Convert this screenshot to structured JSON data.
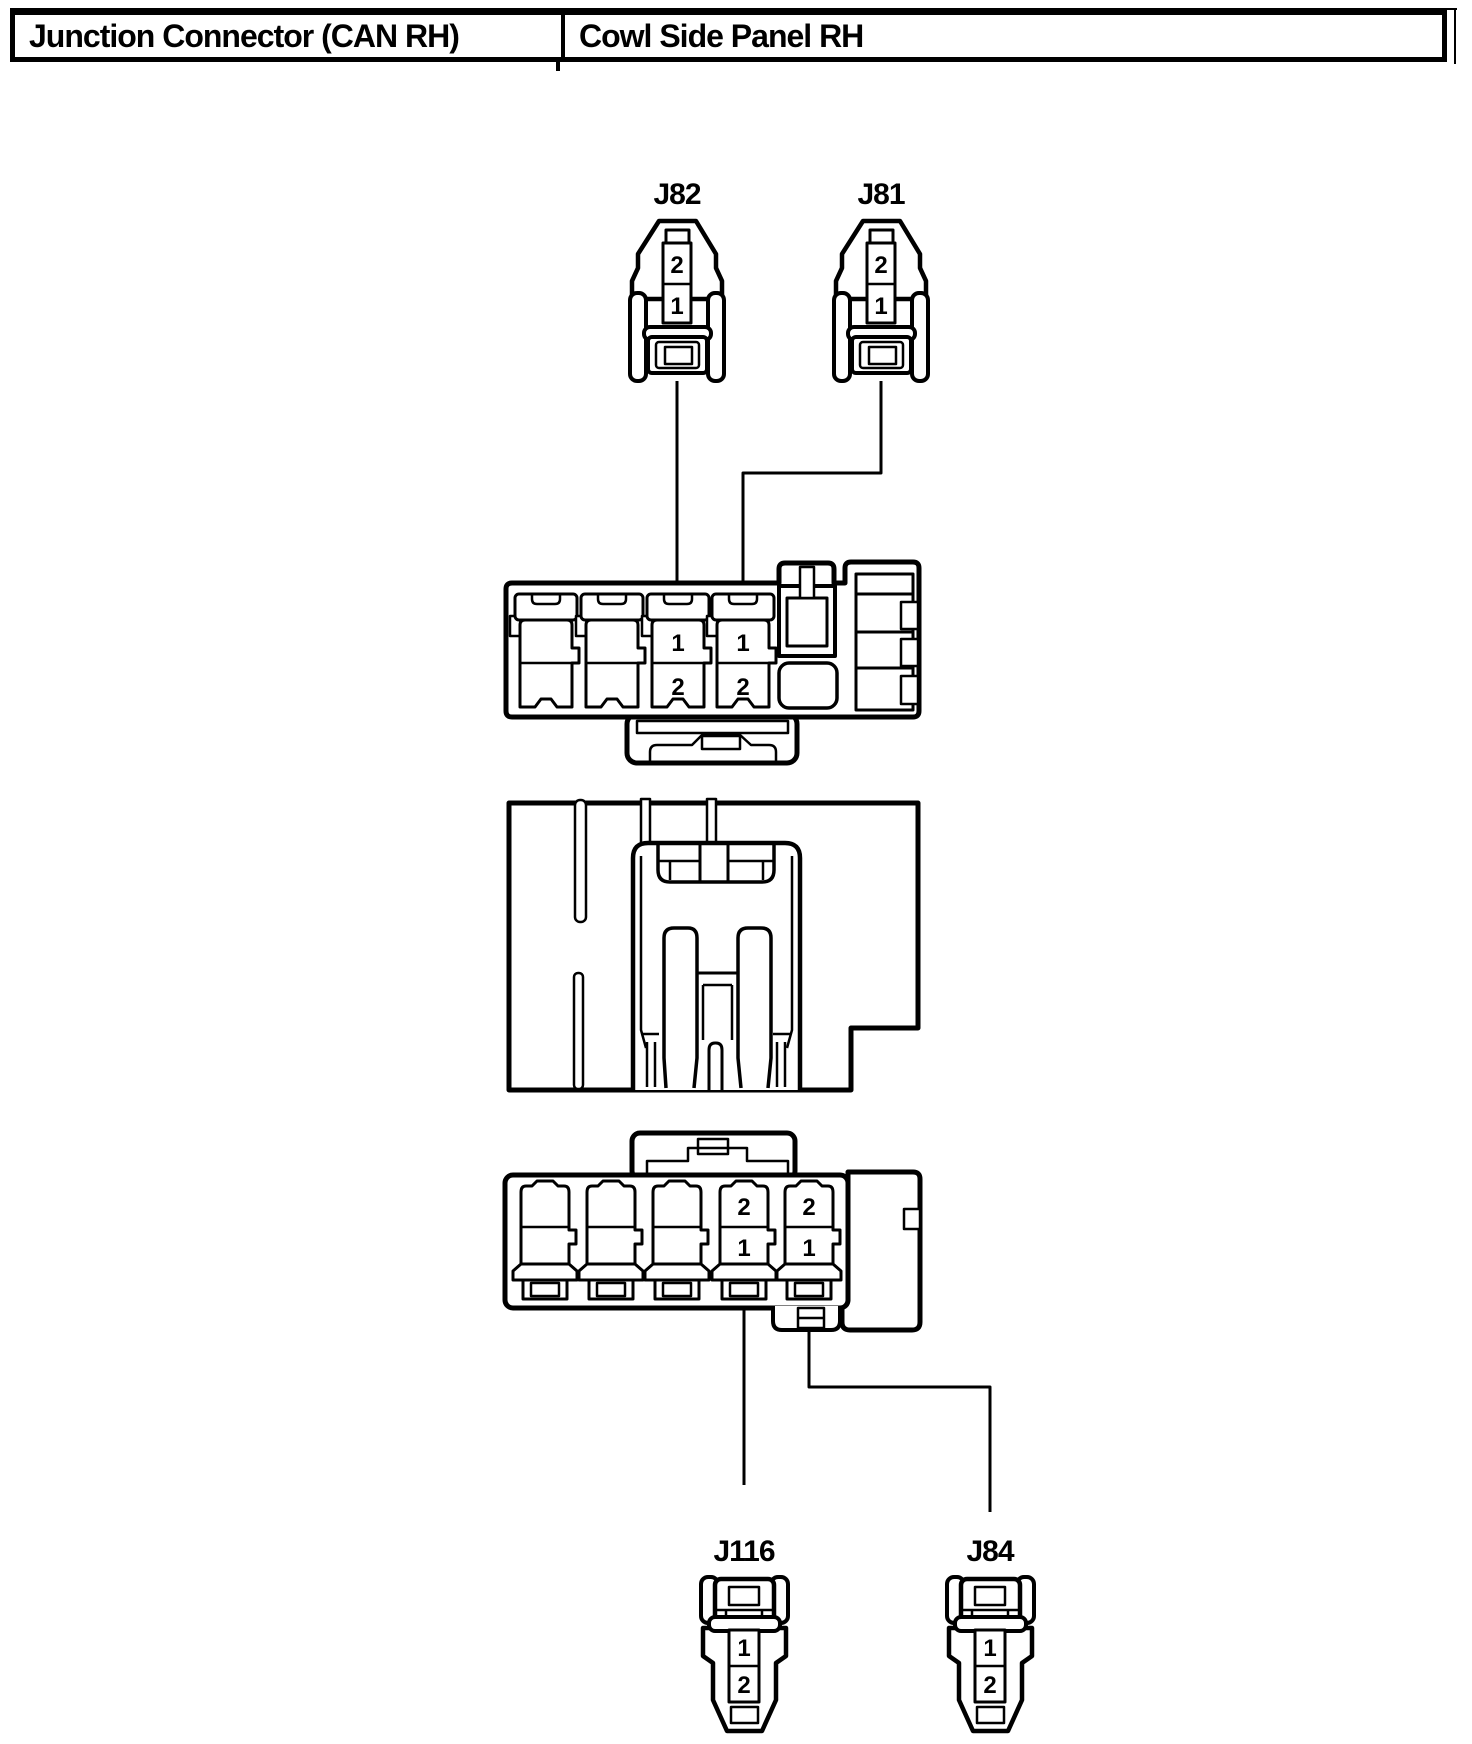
{
  "header": {
    "left_cell": "Junction Connector (CAN RH)",
    "right_cell": "Cowl Side Panel RH"
  },
  "top_connectors": {
    "j82": {
      "label": "J82",
      "pin_top": "2",
      "pin_bottom": "1"
    },
    "j81": {
      "label": "J81",
      "pin_top": "2",
      "pin_bottom": "1"
    }
  },
  "upper_block": {
    "cavity3": {
      "pin_top": "1",
      "pin_bottom": "2"
    },
    "cavity4": {
      "pin_top": "1",
      "pin_bottom": "2"
    }
  },
  "lower_block": {
    "cavity4": {
      "pin_top": "2",
      "pin_bottom": "1"
    },
    "cavity5": {
      "pin_top": "2",
      "pin_bottom": "1"
    }
  },
  "bottom_connectors": {
    "j116": {
      "label": "J116",
      "pin_top": "1",
      "pin_bottom": "2"
    },
    "j84": {
      "label": "J84",
      "pin_top": "1",
      "pin_bottom": "2"
    }
  },
  "colors": {
    "ink": "#000000",
    "paper": "#ffffff"
  }
}
